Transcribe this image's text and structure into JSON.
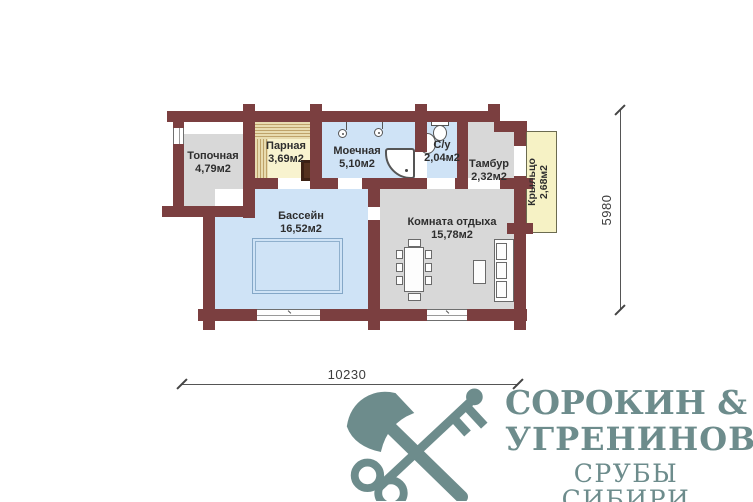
{
  "plan": {
    "rooms": [
      {
        "name": "Топочная",
        "area": "4,79м2"
      },
      {
        "name": "Парная",
        "area": "3,69м2"
      },
      {
        "name": "Моечная",
        "area": "5,10м2"
      },
      {
        "name": "С/у",
        "area": "2,04м2"
      },
      {
        "name": "Тамбур",
        "area": "2,32м2"
      },
      {
        "name": "Бассейн",
        "area": "16,52м2"
      },
      {
        "name": "Комната отдыха",
        "area": "15,78м2"
      },
      {
        "name": "Крыльцо",
        "area": "2,68м2"
      }
    ],
    "dimensions": {
      "width": "10230",
      "height": "5980"
    },
    "colors": {
      "wall": "#7b3f40",
      "wet_room": "#cfe3f6",
      "dry_room": "#d8d8d8",
      "sauna_room": "#f8f3cf",
      "porch": "#f6f2c5",
      "wood_bench": "#e6d7a6",
      "stove": "#54311e",
      "logo": "#6d8c8c"
    }
  },
  "logo": {
    "name1": "СОРОКИН",
    "amp": "&",
    "name2": "УГРЕНИНОВ",
    "tagline": "СРУБЫ СИБИРИ"
  }
}
